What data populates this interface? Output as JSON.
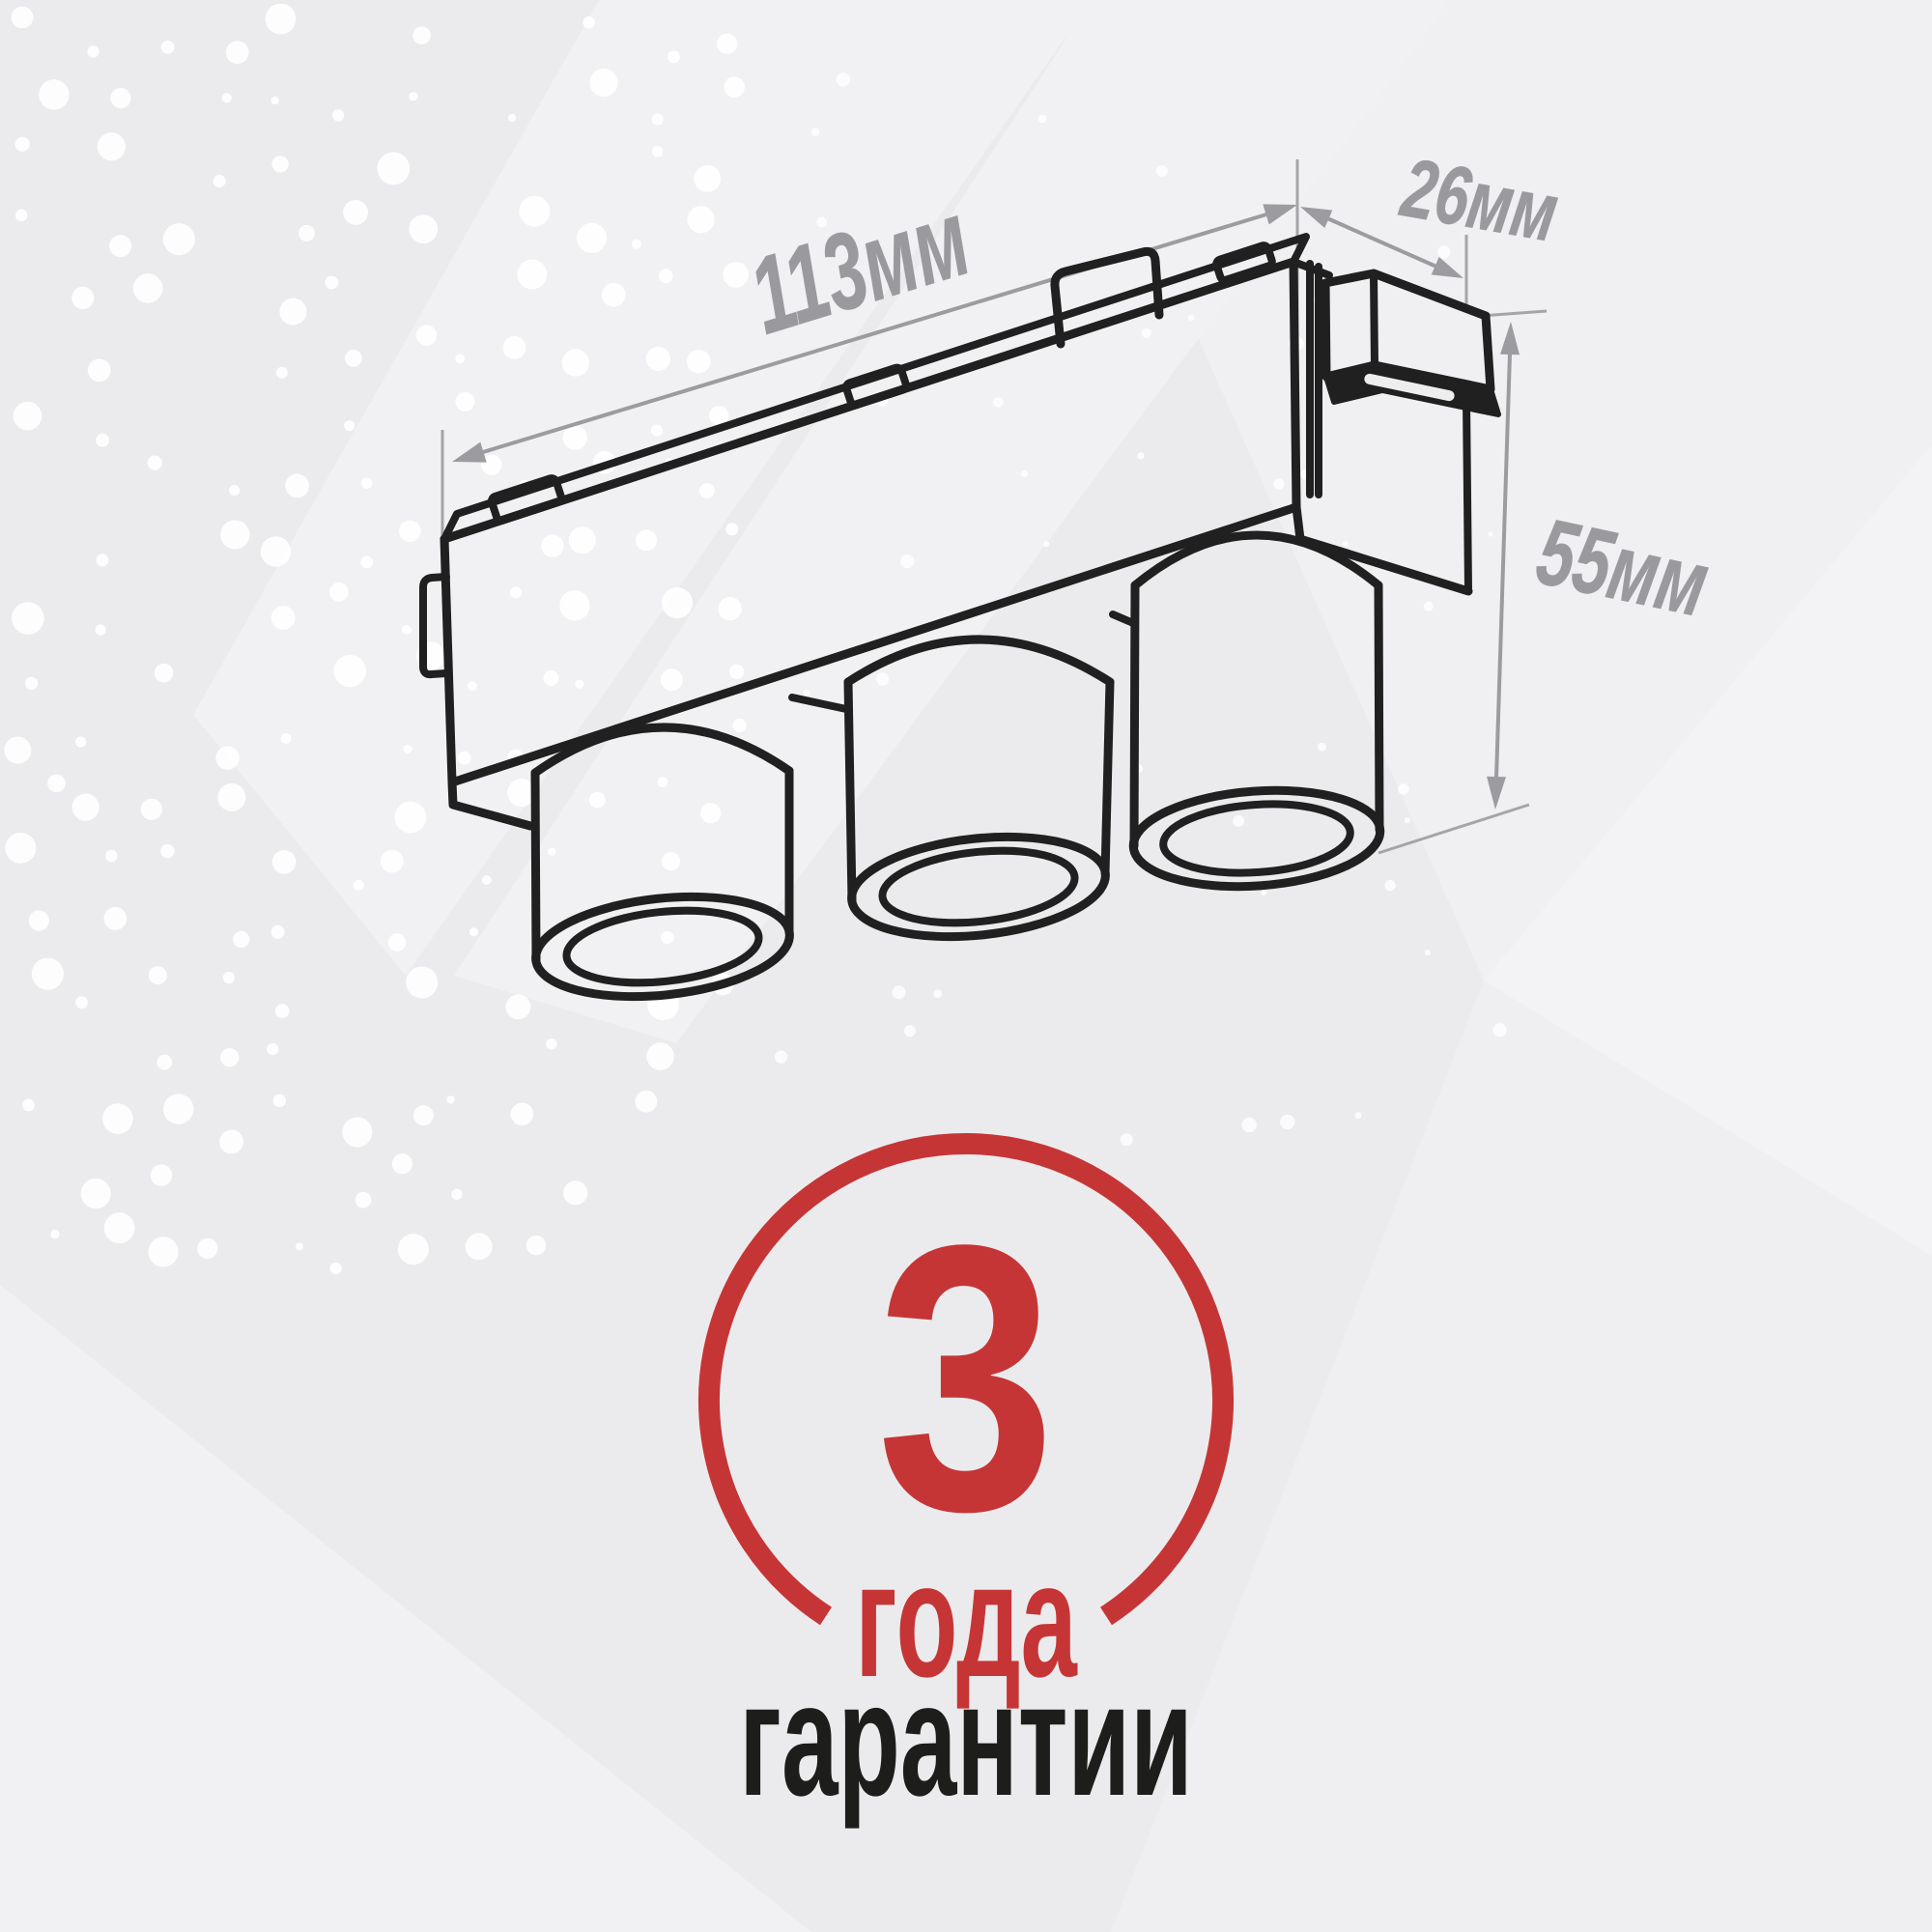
{
  "image_type": "track light fixture technical drawing with warranty badge",
  "drawing": {
    "dimension_labels": {
      "length": "113мм",
      "depth": "26мм",
      "height": "55мм"
    }
  },
  "warranty_badge": {
    "number": "3",
    "unit": "года",
    "caption": "гарантии"
  },
  "colors": {
    "background": "#ebebed",
    "line_black": "#202020",
    "dim_gray": "#9c9ca0",
    "label_gray": "#9a9a9e",
    "accent_red": "#c63536",
    "text_dark": "#1d1d1b",
    "dot_white": "#ffffff",
    "slot_fill": "#eeeeef"
  }
}
